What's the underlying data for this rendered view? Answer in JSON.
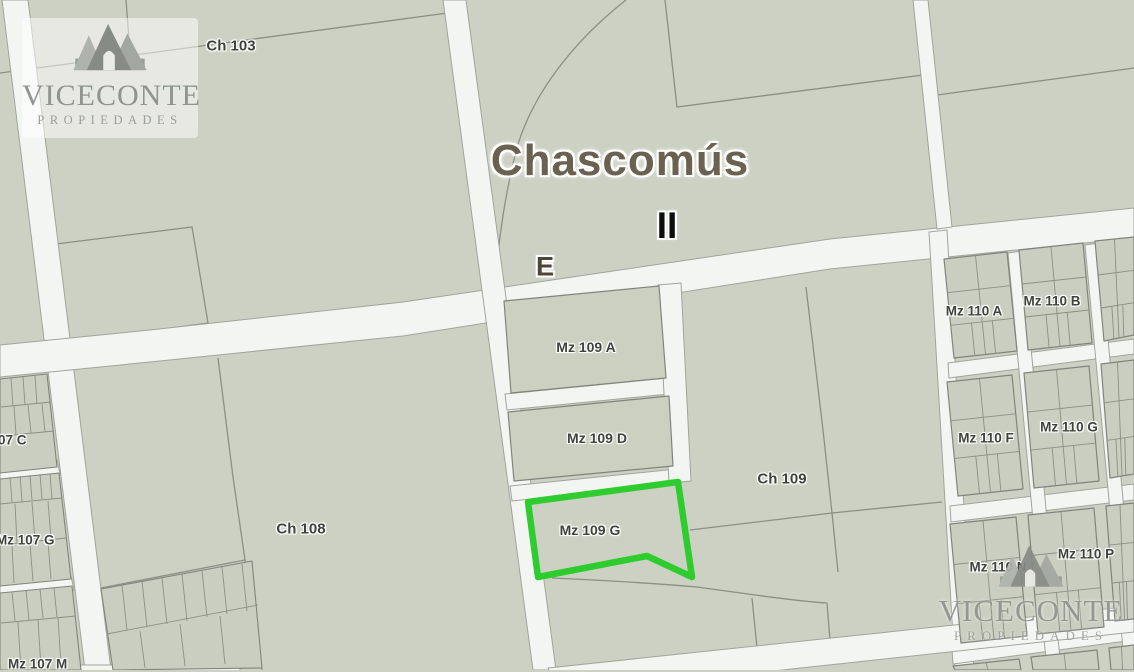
{
  "branding": {
    "name": "VICECONTE",
    "tagline": "PROPIEDADES",
    "logo_icon": "mountains-icon"
  },
  "map": {
    "city_title": "Chascomús",
    "zone_label": "II",
    "corner_label": "E",
    "highlight_color": "#2ecc2e",
    "colors": {
      "parcel_fill": "#cdd1c3",
      "block_fill": "#c9cec0",
      "road_fill": "#f3f5f3",
      "boundary_line": "#8b9085",
      "label_text": "#3e433b",
      "title_text": "#6b6150"
    },
    "labels": {
      "ch103": "Ch 103",
      "ch108": "Ch 108",
      "ch109": "Ch 109",
      "mz109a": "Mz 109 A",
      "mz109d": "Mz 109 D",
      "mz109g": "Mz 109 G",
      "mz110a": "Mz 110 A",
      "mz110b": "Mz 110 B",
      "mz110f": "Mz 110 F",
      "mz110g": "Mz 110 G",
      "mz110n": "Mz 110 N",
      "mz110p": "Mz 110 P",
      "mz107c": "07 C",
      "mz107g": "Mz 107 G",
      "mz107m": "Mz 107 M"
    }
  }
}
